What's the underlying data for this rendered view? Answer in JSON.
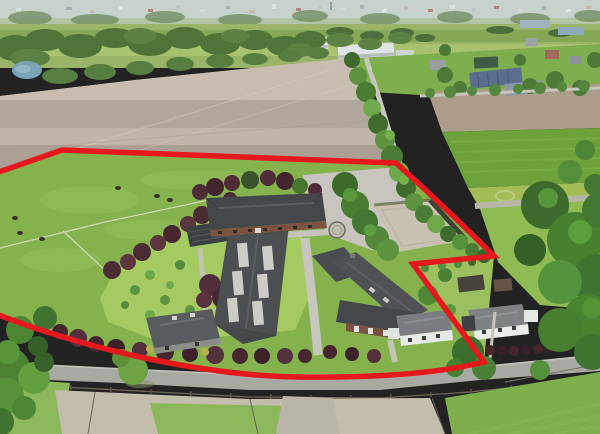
{
  "scene": {
    "type": "aerial-photograph",
    "subject": "rural equestrian estate outlined with a red property boundary",
    "setting": "flat farmland: plowed fields, pastures, tree lines, farm buildings, hazy village horizon"
  },
  "boundary": {
    "color": "#e5191d",
    "stroke_width": 5.5,
    "path": "M -4 173 L 62 150 L 396 163 Q 444 206 494 256 L 413 264 L 484 362 C 440 373 380 378 300 377 C 210 376 95 352 -4 314"
  },
  "palette": {
    "haze_sky": "#c7d2cc",
    "distant_field_green": "#9ab567",
    "forest_green": "#557a3f",
    "lake_blue": "#7aa2b5",
    "plowed_field_taupe": "#b7aca0",
    "pasture_green": "#86b24e",
    "garden_lawn_green": "#a6ca62",
    "crop_field_green": "#6da13a",
    "copper_beech_maroon": "#4b2c34",
    "tree_green": "#4f8a36",
    "roof_dark_gray": "#4a4d4f",
    "skylight_white": "#d8d7cf",
    "brick_facade": "#7d5240",
    "arena_sand": "#c9c1b2",
    "road_gray": "#a9a9a3",
    "white_building": "#e8ebe9"
  },
  "features": {
    "inside_boundary": [
      "pasture with animals",
      "garden with trees",
      "stable building",
      "skylight barn",
      "house complex",
      "guest house",
      "outdoor sand arena",
      "copper beech hedgerows",
      "driveways"
    ],
    "outside_boundary": [
      "large plowed field",
      "neighbor white house",
      "solar-roof farm cluster",
      "road with fence",
      "paddocks",
      "tree line",
      "distant village"
    ]
  }
}
